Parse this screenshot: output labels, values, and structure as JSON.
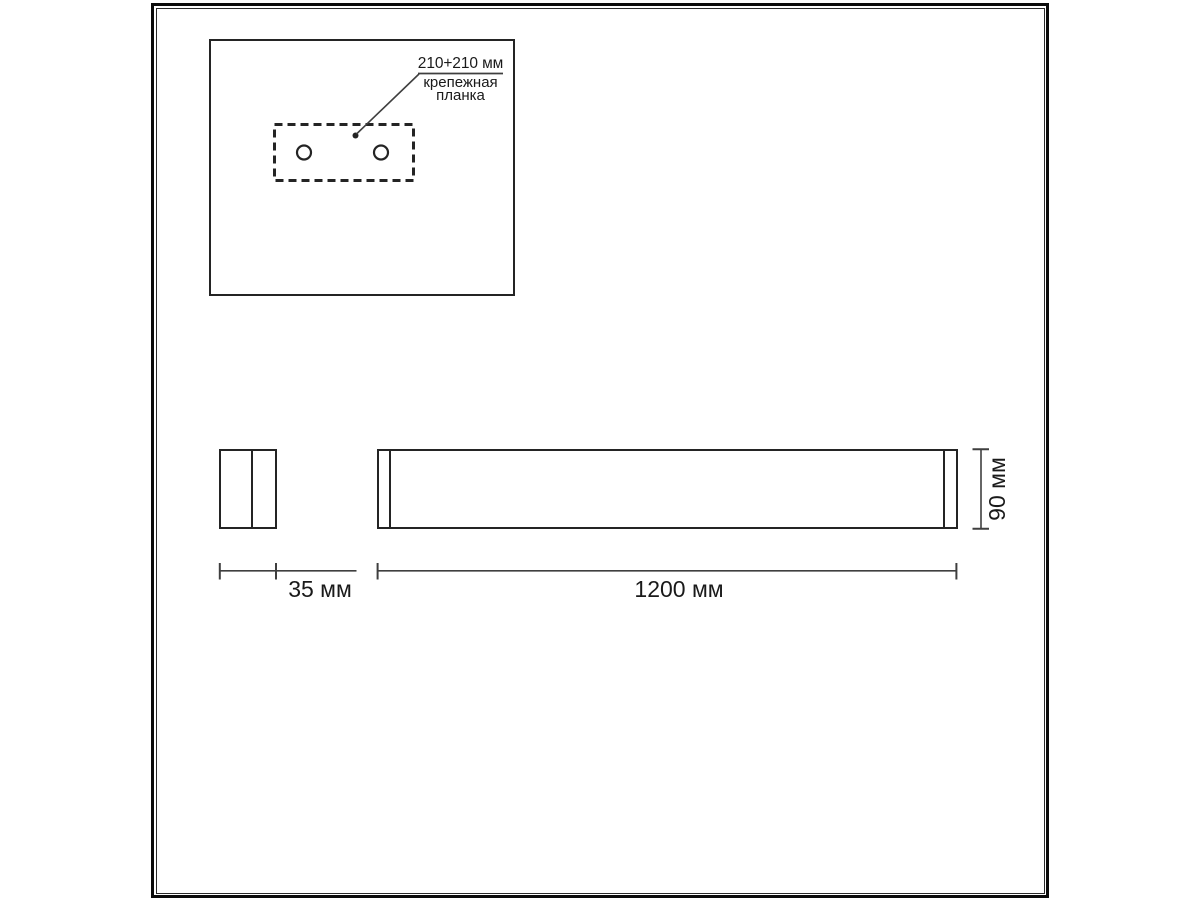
{
  "colors": {
    "background": "#ffffff",
    "line": "#242424",
    "dim_line": "#3f3f3f",
    "text": "#1a1a1a"
  },
  "inset": {
    "annotation": {
      "dimension": "210+210 мм",
      "label_line1": "крепежная",
      "label_line2": "планка"
    }
  },
  "dimensions": {
    "side_width": "35 мм",
    "front_length": "1200 мм",
    "front_height": "90 мм"
  }
}
